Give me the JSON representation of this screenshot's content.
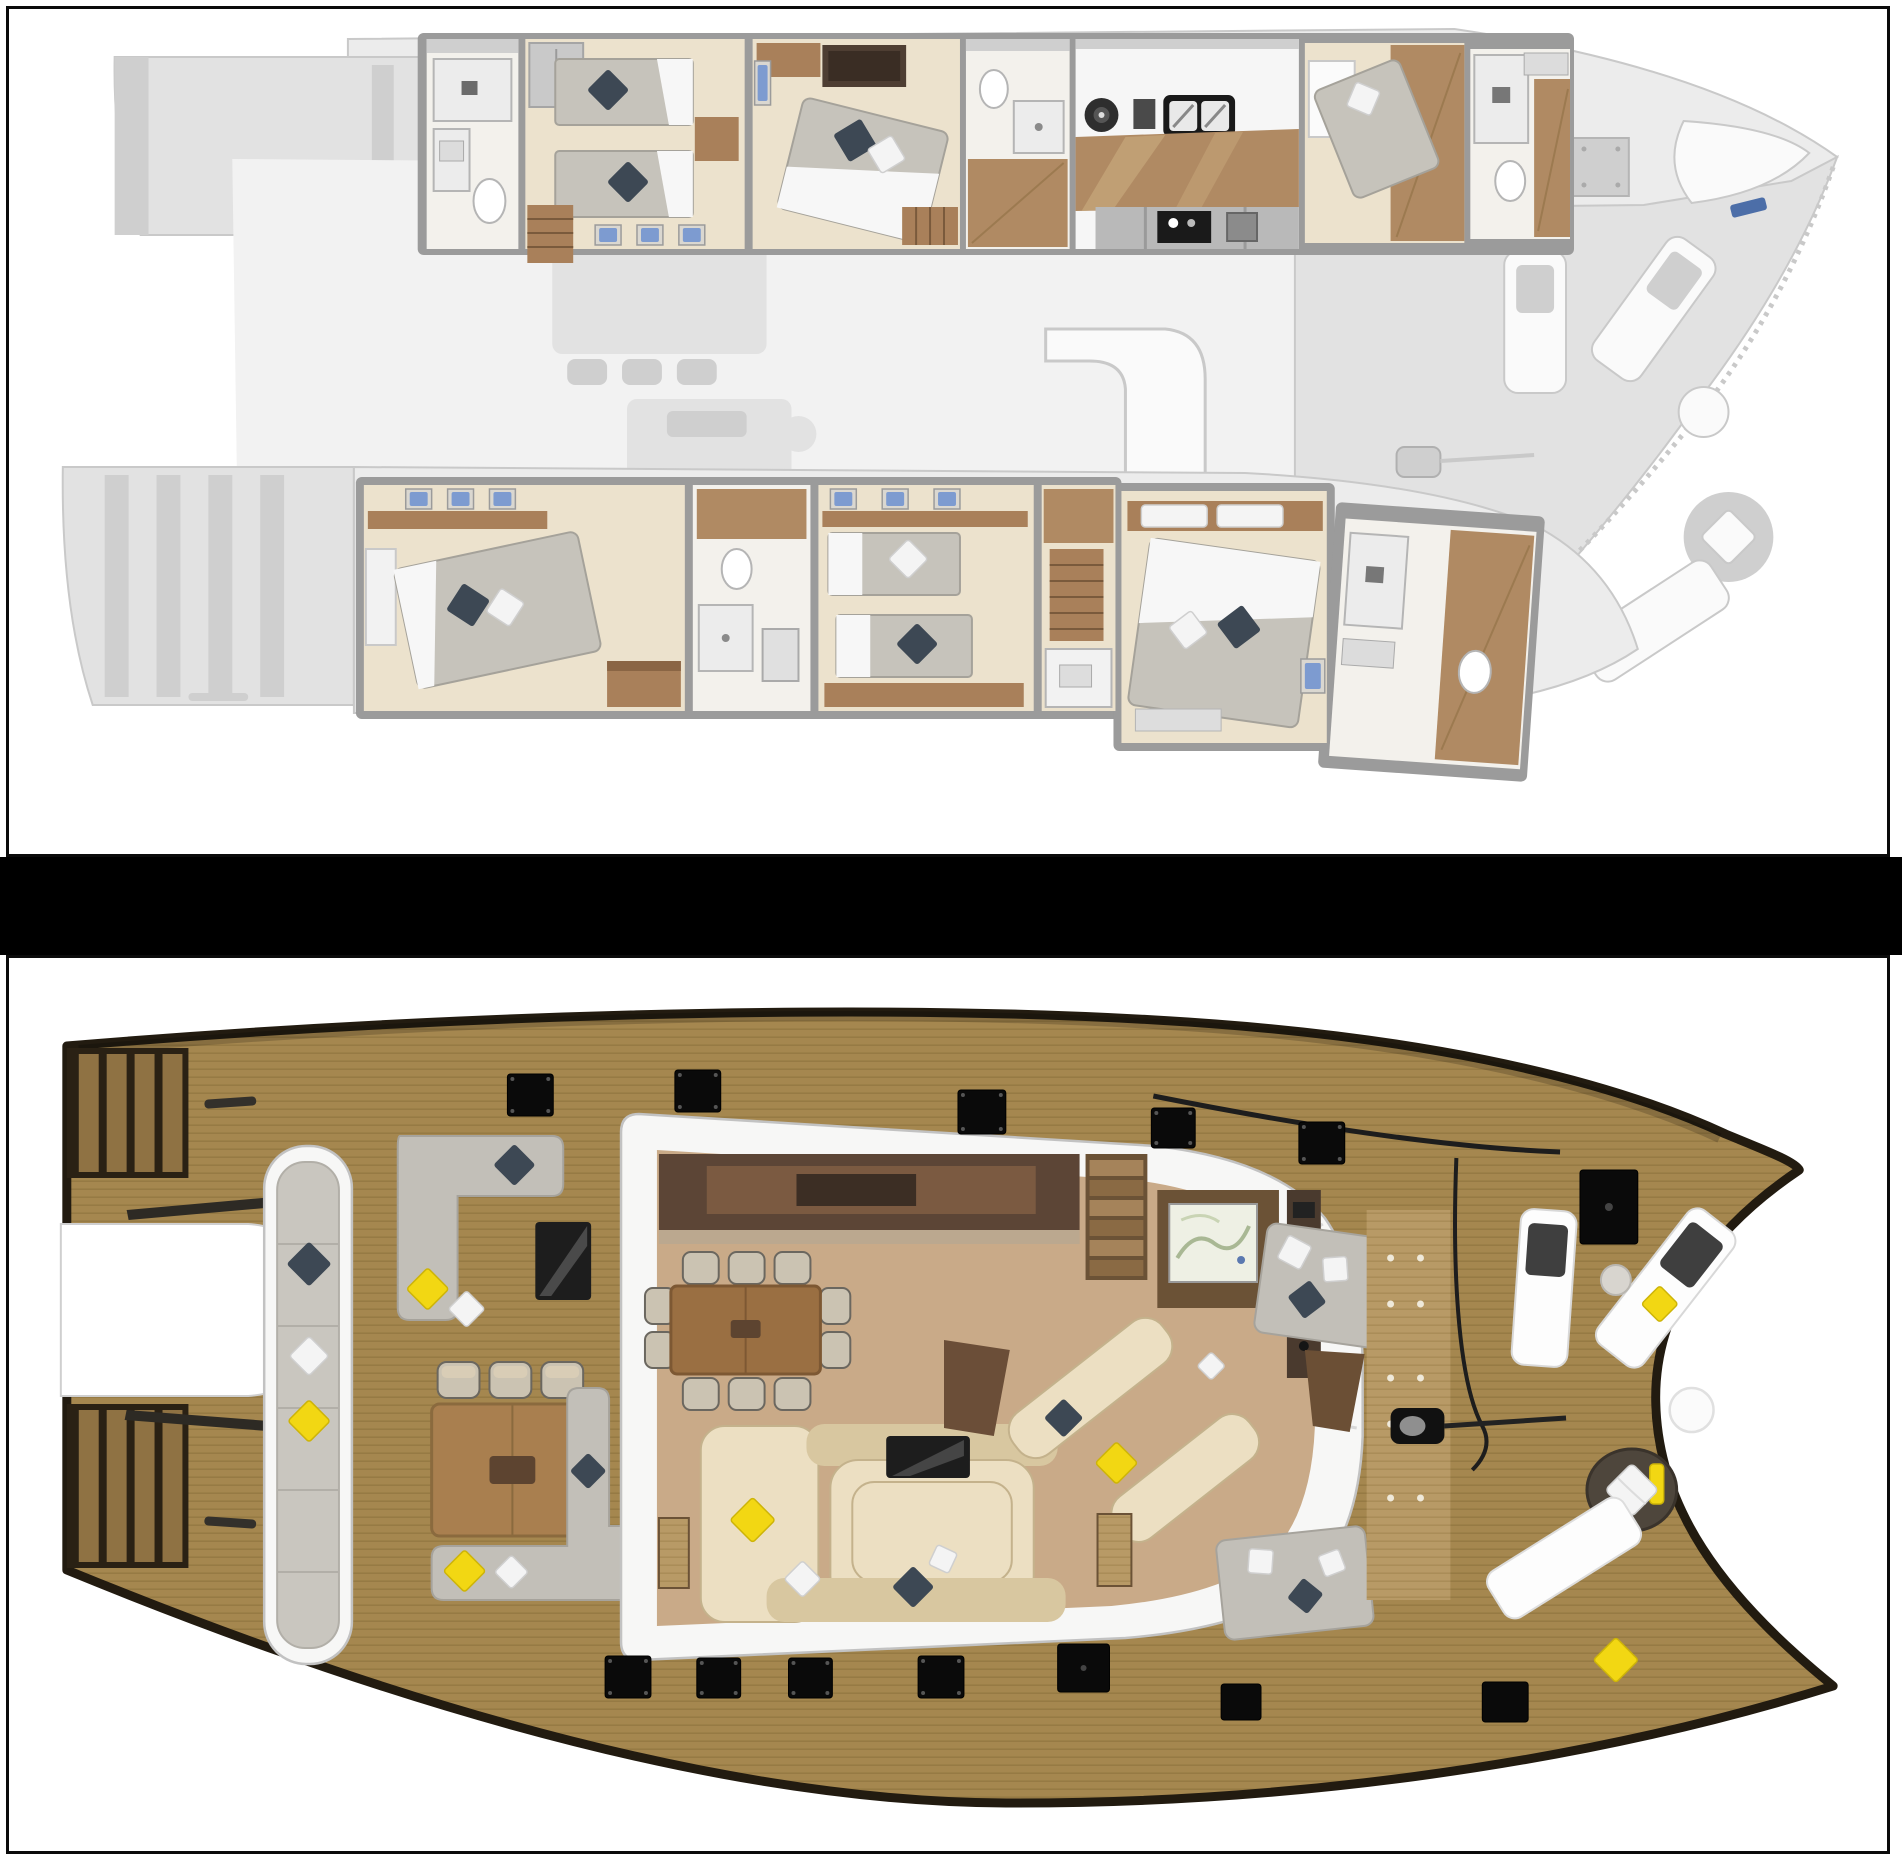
{
  "document": {
    "kind": "catamaran-yacht-deck-plans",
    "panel_count": 2,
    "panels": [
      {
        "id": "lower-deck",
        "description": "lower deck cabin layout, hull cabins rendered in colour, main deck ghosted grey, bow to the right"
      },
      {
        "id": "main-deck",
        "description": "main deck layout in full colour with teak decks, saloon, cockpit and foredeck, bow to the right"
      }
    ]
  },
  "colors": {
    "frame": "#0b0b0b",
    "band": "#000000",
    "panel_bg": "#ffffff",
    "ghost_fill": "#ececec",
    "ghost_mid": "#e2e2e2",
    "ghost_dark": "#cfcfcf",
    "ghost_stroke": "#c9c9c9",
    "ghost_white": "#fafafa",
    "wall": "#9b9b9b",
    "room_floor": "#ece2cd",
    "room_floor_light": "#f3f1ec",
    "wood": "#a9805a",
    "wood_dark": "#8a6544",
    "wood_floor": "#b08a63",
    "mattress": "#c6c3bb",
    "mattress_line": "#a5a29a",
    "sheet": "#f7f7f7",
    "pillow_dark": "#3d4854",
    "pillow_white": "#f4f4f4",
    "pillow_yellow": "#f2d713",
    "hatch_blue": "#7d9bd0",
    "hatch_blue_dark": "#4c6ea8",
    "cabinet_dark": "#4e3e33",
    "appliance_black": "#1a1a1a",
    "teak": "#a5874f",
    "teak_line": "#8a6f3b",
    "teak_light": "#b89a66",
    "hull_edge": "#221b10",
    "saloon_floor": "#c9aa88",
    "saloon_wood": "#5c4536",
    "saloon_wood_mid": "#7b5a41",
    "cream": "#ecdfc2",
    "cream_dark": "#d8c7a0",
    "cream_stroke": "#c4b28c",
    "sofa_grey": "#c2bfb8",
    "sofa_grey_stroke": "#a6a39c",
    "cushion_grey": "#c9c6bf",
    "white_struct": "#f7f7f6",
    "white_stroke": "#c2c2c2",
    "tv": "#1d1d1d",
    "hatch_black": "#0a0a0a",
    "map_screen": "#eef0e4"
  },
  "upper_deck": {
    "name": "lower-deck-cabins-plan",
    "port_hull_rooms": [
      {
        "name": "aft-bathroom",
        "fixtures": [
          "shower",
          "sink",
          "toilet"
        ]
      },
      {
        "name": "twin-guest-cabin",
        "beds": 2,
        "pillows": [
          "dark",
          "dark"
        ],
        "blue_hatches": 3,
        "stairs": true
      },
      {
        "name": "vip-double-cabin",
        "beds": 1,
        "pillows": [
          "dark",
          "white"
        ],
        "cabinet": "dark-dresser",
        "stairs": true
      },
      {
        "name": "shower-room",
        "fixtures": [
          "toilet",
          "shower",
          "sink"
        ]
      },
      {
        "name": "galley",
        "fixtures": [
          "burner",
          "double-sink",
          "cooktop",
          "appliances"
        ],
        "floor": "wood"
      },
      {
        "name": "crew-cabin",
        "beds": 1,
        "pillows": [
          "white"
        ]
      },
      {
        "name": "bow-bathroom",
        "fixtures": [
          "shower",
          "toilet",
          "sink"
        ],
        "floor": "wood"
      }
    ],
    "starboard_hull_rooms": [
      {
        "name": "aft-double-cabin",
        "beds": 1,
        "pillows": [
          "dark",
          "white"
        ],
        "blue_hatches": 3
      },
      {
        "name": "bathroom",
        "fixtures": [
          "toilet",
          "shower",
          "sink"
        ]
      },
      {
        "name": "twin-guest-cabin",
        "beds": 2,
        "pillows": [
          "white",
          "dark"
        ],
        "blue_hatches": 3
      },
      {
        "name": "corridor-with-stairs",
        "fixtures": [
          "toilet",
          "shower-box"
        ],
        "stairs": true
      },
      {
        "name": "master-cabin",
        "beds": 1,
        "pillows": [
          "dark",
          "white"
        ],
        "headboard_pillows": 2,
        "blue_hatch": 1
      },
      {
        "name": "master-bathroom",
        "fixtures": [
          "shower",
          "toilet",
          "sink"
        ],
        "floor": "wood"
      }
    ],
    "ghost_features": [
      "port-swim-platform-steps",
      "starboard-swim-platform-steps",
      "saloon-dining-table",
      "saloon-sofa-outline",
      "helm-console",
      "front-cockpit-seats",
      "foredeck-loungers",
      "foredeck-round-table-with-pillow",
      "bow-trampoline",
      "anchor-locker",
      "blue-cleats",
      "bow-netting-edge"
    ]
  },
  "main_deck": {
    "name": "main-deck-plan",
    "aft_deck": {
      "swim_platform_steps": 2,
      "transom_bench": {
        "cushions": 6,
        "pillows": [
          "dark",
          "white",
          "yellow"
        ]
      },
      "lounge": {
        "shape": "L",
        "pillows": [
          "dark",
          "yellow",
          "white"
        ],
        "tv": true
      },
      "dining": {
        "table": "wood",
        "chairs": 3,
        "sofa_pillows": [
          "yellow",
          "white",
          "dark"
        ]
      }
    },
    "saloon": {
      "galley_counter": "dark-wood",
      "stairs": true,
      "nav_station": {
        "screen": "chart-map"
      },
      "electronics_panel": true,
      "dining_table_seats": 10,
      "u_sofa": {
        "tv": true,
        "pillows": [
          "yellow",
          "white",
          "dark",
          "white"
        ]
      },
      "starboard_sofas": {
        "pillows": [
          "dark",
          "yellow",
          "white"
        ]
      },
      "companionways": 2
    },
    "side_decks": {
      "sunpads": [
        {
          "pillows": [
            "white",
            "white",
            "dark"
          ]
        },
        {
          "pillows": [
            "white",
            "dark",
            "white"
          ]
        }
      ],
      "rigging": [
        "shroud-line",
        "halyard-cable",
        "winch"
      ]
    },
    "foredeck": {
      "loungers": [
        {
          "cushion": "dark"
        },
        {
          "cushion": "dark",
          "pillow": "yellow"
        },
        {
          "cushion": "none"
        }
      ],
      "side_table": "small-grey-round",
      "white_round_table": true,
      "round_daybed": {
        "pillows": [
          "white",
          "yellow"
        ]
      },
      "bow_pillow": "yellow",
      "anchor_locker_hatch": true
    },
    "deck_hatches_small": 10,
    "deck_hatches_large": 2
  }
}
